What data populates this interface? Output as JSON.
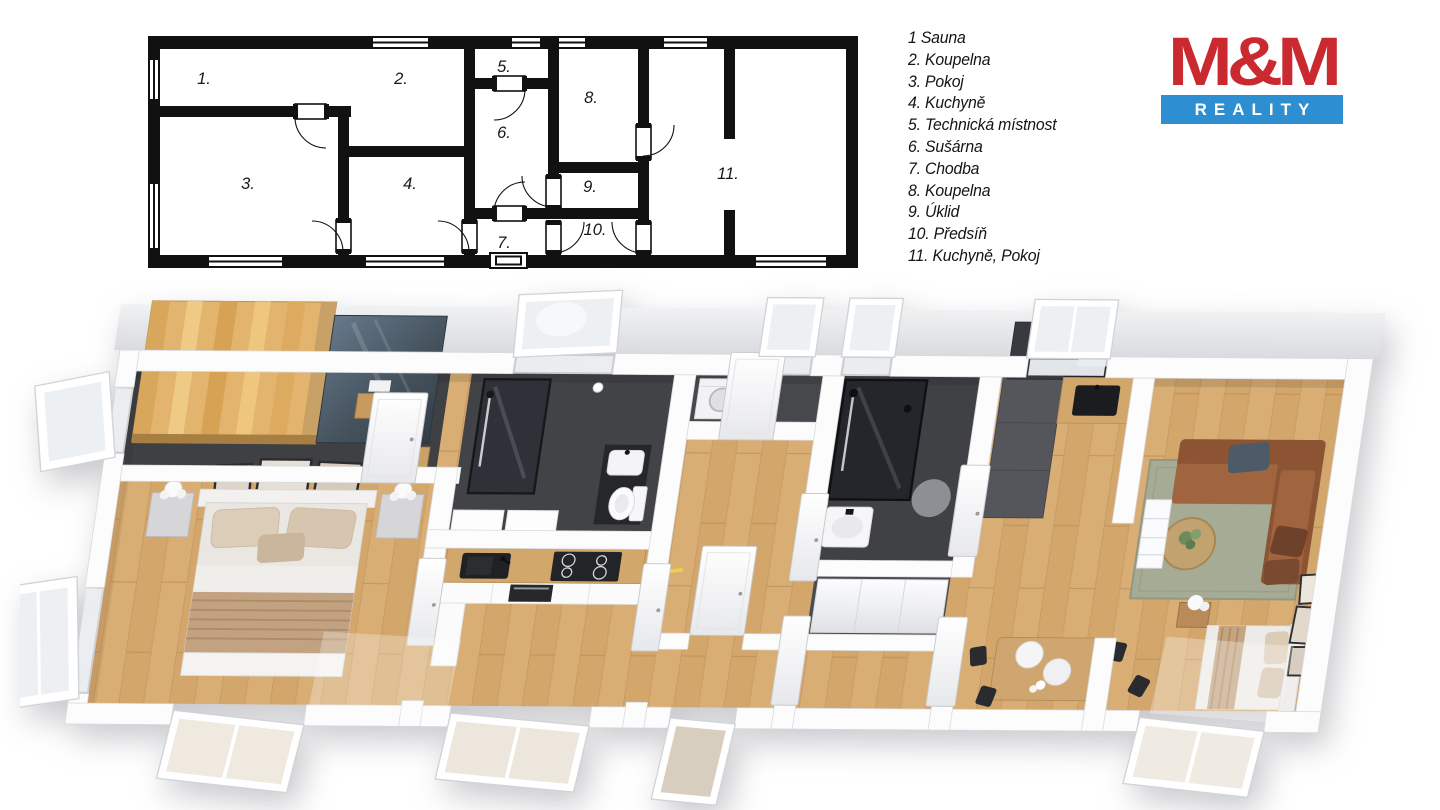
{
  "legend": {
    "items": [
      "1 Sauna",
      "2. Koupelna",
      "3. Pokoj",
      "4. Kuchyně",
      "5. Technická místnost",
      "6. Sušárna",
      "7. Chodba",
      "8. Koupelna",
      "9. Úklid",
      "10. Předsíň",
      "11. Kuchyně, Pokoj"
    ]
  },
  "plan2d": {
    "labels": [
      "1.",
      "2.",
      "3.",
      "4.",
      "5.",
      "6.",
      "7.",
      "8.",
      "9.",
      "10.",
      "11."
    ]
  },
  "logo": {
    "top": "M&M",
    "bottom": "REALITY"
  },
  "colors": {
    "logo_red": "#c9292f",
    "logo_blue": "#2e8ed2",
    "plan_wall": "#111111",
    "wood_floor": "#d9ae74",
    "dark_floor": "#3f4043",
    "sauna_wood": "#e3b46d",
    "sauna_glass": "#4c5a69",
    "sofa_brown": "#9a5f3b",
    "rug_green": "#a6ab95",
    "counter_wood": "#d2a76c"
  }
}
